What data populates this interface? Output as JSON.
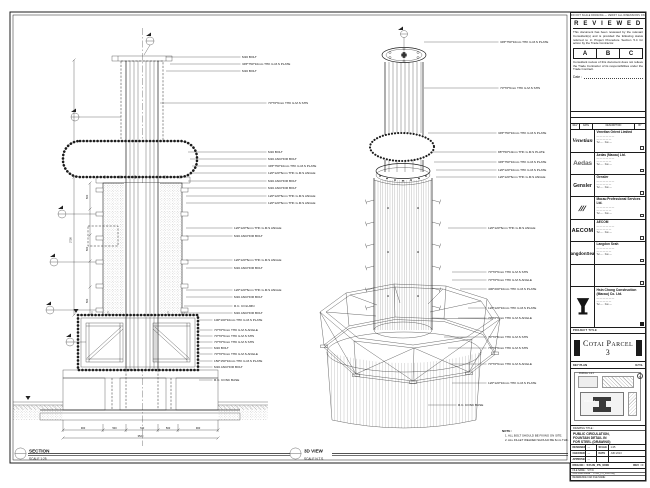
{
  "sheet": {
    "edge_note": "DO NOT SCALE DRAWING — VERIFY ALL DIMENSIONS ON SITE",
    "ink": "#1c1c1c",
    "paper": "#ffffff"
  },
  "left_view": {
    "name": "SECTION",
    "scale": "SCALE 1:25",
    "labels": [
      {
        "y": 57,
        "x": 242,
        "lx": 166,
        "text": "M16 BOLT"
      },
      {
        "y": 64,
        "x": 242,
        "lx": 170,
        "text": "345*750*10mm THK G.M.S PLATE"
      },
      {
        "y": 71,
        "x": 242,
        "lx": 166,
        "text": "M16 BOLT"
      },
      {
        "y": 103,
        "x": 268,
        "lx": 160,
        "text": "70*70*6mm THK G.M.S SHS"
      },
      {
        "y": 152,
        "x": 268,
        "lx": 188,
        "text": "M16 BOLT"
      },
      {
        "y": 159,
        "x": 268,
        "lx": 190,
        "text": "M16 ANCHOR BOLT"
      },
      {
        "y": 166,
        "x": 268,
        "lx": 192,
        "text": "345*750*10mm THK G.M.S PLATE"
      },
      {
        "y": 173,
        "x": 268,
        "lx": 190,
        "text": "120*120*6mm THK G.M.S ANGLE"
      },
      {
        "y": 181,
        "x": 268,
        "lx": 188,
        "text": "M16 ANCHOR BOLT"
      },
      {
        "y": 188,
        "x": 268,
        "lx": 188,
        "text": "M16 ANCHOR BOLT"
      },
      {
        "y": 196,
        "x": 268,
        "lx": 186,
        "text": "120*120*6mm THK G.M.S ANGLE"
      },
      {
        "y": 203,
        "x": 268,
        "lx": 186,
        "text": "120*120*6mm THK G.M.S ANGLE"
      },
      {
        "y": 228,
        "x": 234,
        "lx": 186,
        "text": "120*120*6mm THK G.M.S ANGLE"
      },
      {
        "y": 236,
        "x": 234,
        "lx": 186,
        "text": "M16 ANCHOR BOLT"
      },
      {
        "y": 260,
        "x": 234,
        "lx": 186,
        "text": "120*120*6mm THK G.M.S ANGLE"
      },
      {
        "y": 268,
        "x": 234,
        "lx": 186,
        "text": "M16 ANCHOR BOLT"
      },
      {
        "y": 290,
        "x": 234,
        "lx": 186,
        "text": "120*120*6mm THK G.M.S ANGLE"
      },
      {
        "y": 297,
        "x": 234,
        "lx": 186,
        "text": "M16 ANCHOR BOLT"
      },
      {
        "y": 306,
        "x": 234,
        "lx": 184,
        "text": "R.C. COLUMN"
      },
      {
        "y": 313,
        "x": 234,
        "lx": 184,
        "text": "M16 ANCHOR BOLT"
      },
      {
        "y": 320,
        "x": 214,
        "lx": 199,
        "text": "100*100*10mm THK G.M.S PLATE"
      },
      {
        "y": 330,
        "x": 214,
        "lx": 199,
        "text": "70*70*6mm THK G.M.S ANGLE"
      },
      {
        "y": 336,
        "x": 214,
        "lx": 199,
        "text": "70*70*6mm THK G.M.S SHS"
      },
      {
        "y": 342,
        "x": 214,
        "lx": 199,
        "text": "70*70*6mm THK G.M.S SHS"
      },
      {
        "y": 348,
        "x": 214,
        "lx": 199,
        "text": "M16 BOLT"
      },
      {
        "y": 354,
        "x": 214,
        "lx": 199,
        "text": "70*70*6mm THK G.M.S ANGLE"
      },
      {
        "y": 361,
        "x": 214,
        "lx": 199,
        "text": "150*150*10mm THK G.M.S PLATE"
      },
      {
        "y": 367,
        "x": 214,
        "lx": 199,
        "text": "M16 ANCHOR BOLT"
      },
      {
        "y": 380,
        "x": 214,
        "lx": 199,
        "text": "R.C. CONC BASE"
      }
    ],
    "dims": [
      {
        "x": 71.5,
        "y": 240,
        "rot": -90,
        "cls": "dim",
        "text": "2750"
      },
      {
        "x": 88,
        "y": 197,
        "rot": -90,
        "cls": "dim",
        "text": "500"
      },
      {
        "x": 88,
        "y": 249,
        "rot": -90,
        "cls": "dim",
        "text": "500"
      },
      {
        "x": 88,
        "y": 301,
        "rot": -90,
        "cls": "dim",
        "text": "500"
      },
      {
        "x": 83,
        "y": 429,
        "cls": "dim",
        "text": "900"
      },
      {
        "x": 114.5,
        "y": 429,
        "cls": "dim",
        "text": "500"
      },
      {
        "x": 142,
        "y": 429,
        "cls": "dim",
        "text": "720"
      },
      {
        "x": 168,
        "y": 429,
        "cls": "dim",
        "text": "500"
      },
      {
        "x": 198,
        "y": 429,
        "cls": "dim",
        "text": "900"
      },
      {
        "x": 140.5,
        "y": 437,
        "cls": "dim",
        "text": "3520"
      }
    ]
  },
  "right_view": {
    "name": "3D VIEW",
    "scale": "SCALE N.T.S.",
    "labels": [
      {
        "y": 42,
        "x": 500,
        "lx": 424,
        "text": "345*750*10mm THK G.M.S PLATE"
      },
      {
        "y": 88,
        "x": 500,
        "lx": 424,
        "text": "70*70*6mm THK G.M.S SHS"
      },
      {
        "y": 133,
        "x": 498,
        "lx": 428,
        "text": "345*750*10mm THK G.M.S PLATE"
      },
      {
        "y": 152,
        "x": 498,
        "lx": 432,
        "text": "88*750*10mm THK G.M.S PLATE"
      },
      {
        "y": 162,
        "x": 498,
        "lx": 434,
        "text": "345*750*10mm THK G.M.S PLATE"
      },
      {
        "y": 170,
        "x": 498,
        "lx": 436,
        "text": "120*120*10mm THK G.M.S PLATE"
      },
      {
        "y": 177,
        "x": 498,
        "lx": 436,
        "text": "120*120*6mm THK G.M.S ANGLE"
      },
      {
        "y": 228,
        "x": 488,
        "lx": 448,
        "text": "120*120*6mm THK G.M.S ANGLE"
      },
      {
        "y": 272,
        "x": 488,
        "lx": 452,
        "text": "70*70*6mm THK G.M.S SHS"
      },
      {
        "y": 280,
        "x": 488,
        "lx": 452,
        "text": "70*70*6mm THK G.M.S ANGLE"
      },
      {
        "y": 289,
        "x": 488,
        "lx": 460,
        "text": "400*200*10mm THK G.M.S PLATE"
      },
      {
        "y": 308,
        "x": 488,
        "lx": 468,
        "text": "120*120*10mm THK G.M.S PLATE"
      },
      {
        "y": 318,
        "x": 488,
        "lx": 458,
        "text": "70*70*6mm THK G.M.S ANGLE"
      },
      {
        "y": 337,
        "x": 488,
        "lx": 444,
        "text": "70*70*6mm THK G.M.S SHS"
      },
      {
        "y": 348,
        "x": 488,
        "lx": 448,
        "text": "70*70*6mm THK G.M.S SHS"
      },
      {
        "y": 364,
        "x": 488,
        "lx": 450,
        "text": "70*70*6mm THK G.M.S ANGLE"
      },
      {
        "y": 383,
        "x": 488,
        "lx": 452,
        "text": "120*120*10mm THK G.M.S PLATE"
      },
      {
        "y": 405,
        "x": 458,
        "lx": 428,
        "text": "R.C. CONC BASE"
      }
    ]
  },
  "notes": {
    "heading": "NOTE :",
    "lines": [
      "1. ALL BOLT SHOULD BE FIXING ON SITE.",
      "2. ALL FILLET WELDED SHOULD BE 6mm THK."
    ]
  },
  "review": {
    "title": "R E V I E W E D",
    "p1": "This document has been reviewed by the relevant Consultant(s) and is provided the following status referred to in Project Procedure Section 5.4 for action by the Trade Contractor.",
    "options": [
      "A",
      "B",
      "C"
    ],
    "p2": "Consultant review of this document does not relieve the Trade Contractor of its responsibilities under the Trade Contract.",
    "date_label": "Date :"
  },
  "rev_table": {
    "headers": [
      "REV",
      "DATE",
      "DESCRIPTION",
      "BY"
    ]
  },
  "companies": [
    {
      "logo": "Venetian",
      "logo_class": "lg-venetian",
      "name": "Venetian Orient Limited",
      "lines": [
        "— — — — — —",
        "— — — — —",
        "Tel — · Fax —"
      ]
    },
    {
      "logo": "Aedas",
      "logo_class": "lg-aedas",
      "name": "Aedas (Macau) Ltd.",
      "lines": [
        "— — — — — —",
        "— — — — —",
        "Tel — · Fax —"
      ]
    },
    {
      "logo": "Gensler",
      "logo_class": "lg-gensler",
      "name": "Gensler",
      "lines": [
        "— — — — — —",
        "— — — — —",
        "Tel — · Fax —"
      ]
    },
    {
      "logo": "///",
      "logo_class": "lg-mps",
      "name": "Macau Professional Services Ltd.",
      "lines": [
        "— — — — — —",
        "— — — — —",
        "Tel — · Fax —"
      ]
    },
    {
      "logo": "AECOM",
      "logo_class": "lg-aecom",
      "name": "AECOM",
      "lines": [
        "— — — — — —",
        "— — — — —",
        "Tel — · Fax —"
      ]
    },
    {
      "logo": "LangdonSeah",
      "logo_class": "lg-ls",
      "name": "Langdon Seah",
      "lines": [
        "— — — — — —",
        "— — — — —",
        "Tel — · Fax —"
      ]
    },
    {
      "logo": "",
      "logo_class": "",
      "name": "",
      "lines": [
        "",
        "",
        ""
      ]
    }
  ],
  "contractor": {
    "name": "Hsin Chong Construction (Macau) Co. Ltd.",
    "lines": [
      "— — — — — —",
      "— — — — —",
      "Tel — · Fax —"
    ]
  },
  "project": {
    "label": "PROJECT TITLE",
    "name": "Cotai Parcel 3"
  },
  "key_plan": {
    "label": "KEY PLAN",
    "scale_note": "N.T.S.",
    "labels": [
      "PARCEL 1 & 2",
      "PARCEL 3"
    ],
    "north": "N"
  },
  "title_block": {
    "title_label": "DRAWING TITLE :",
    "title_lines": [
      "PUBLIC CIRCULATION,",
      "FOUNTAIN DETAIL IN",
      "FOR STEEL (DRAWING)"
    ],
    "rows": [
      {
        "k": "DESIGNED",
        "v": "—",
        "k2": "SCALE",
        "v2": "1:25"
      },
      {
        "k": "CHECKED",
        "v": "—",
        "k2": "DATE",
        "v2": "JUN 2013"
      },
      {
        "k": "APPROVED",
        "v": "—",
        "k2": "",
        "v2": ""
      }
    ],
    "dwg_label": "DWG NO :",
    "dwg_no": "SYLW_PS_0000",
    "rev_label": "REV :",
    "rev": "C",
    "files": [
      {
        "k": "FILE NAME :",
        "v": "SYLW"
      },
      {
        "k": "CAD FILE NAME :",
        "v": "SYLW_PS_0000.dwg"
      },
      {
        "k": "REFERENCE CAD FILE NAME :",
        "v": ""
      }
    ]
  }
}
